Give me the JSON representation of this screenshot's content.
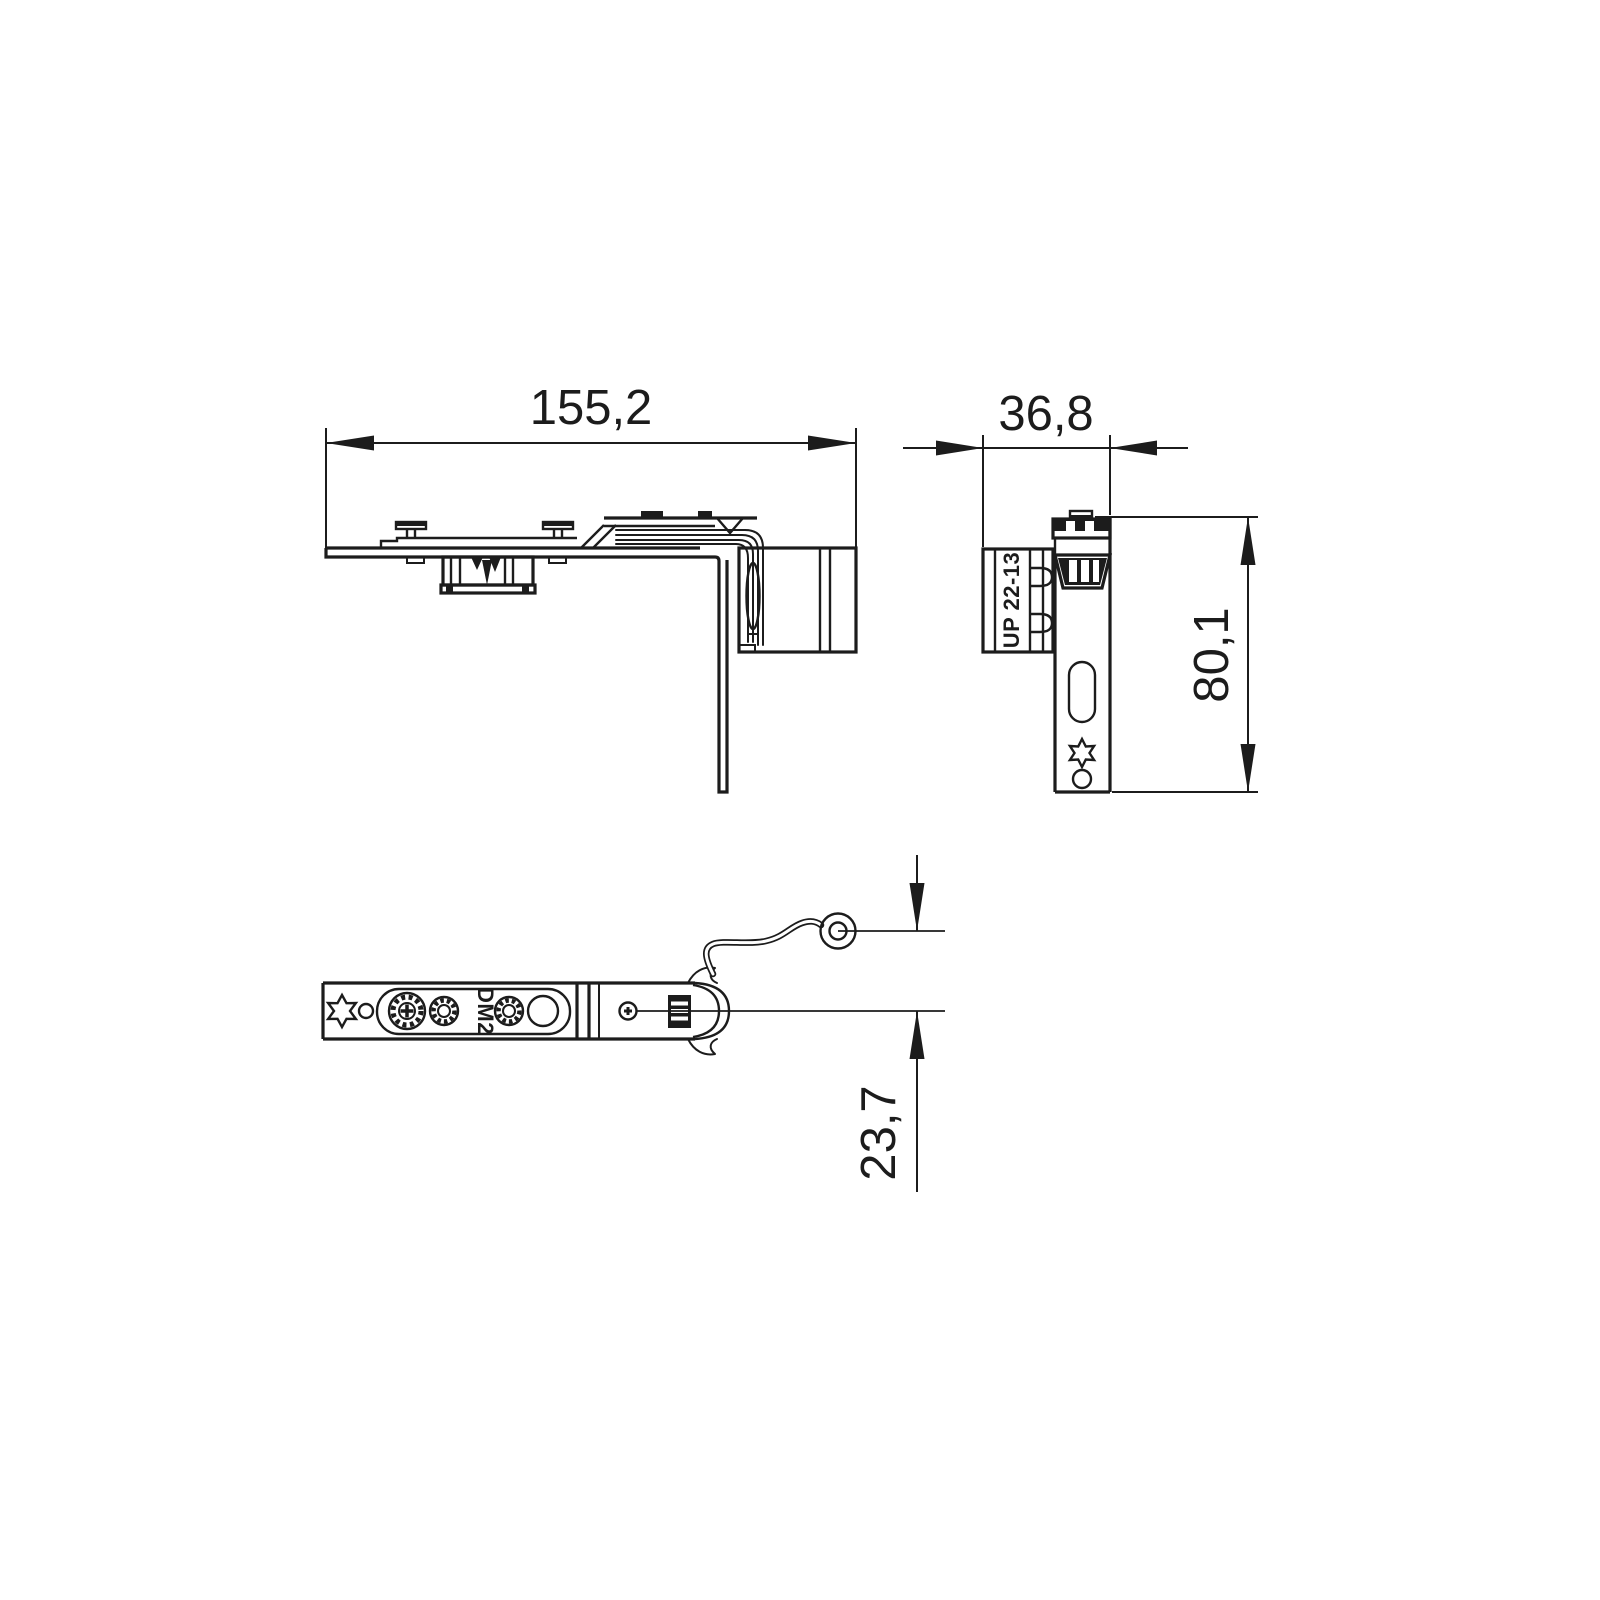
{
  "canvas": {
    "background": "#ffffff",
    "line_color": "#1c1c1c",
    "kind": "technical-drawing",
    "width_px": 1600,
    "height_px": 1600
  },
  "dimensions": {
    "overall_length": {
      "label": "155,2",
      "value": 155.2
    },
    "depth": {
      "label": "36,8",
      "value": 36.8
    },
    "height": {
      "label": "80,1",
      "value": 80.1
    },
    "pin_offset": {
      "label": "23,7",
      "value": 23.7
    }
  },
  "views": {
    "side": {
      "id": "side-view",
      "features": [
        "mounting-studs",
        "gearbox-block",
        "corner-bend-bands",
        "roller-block",
        "long-leg"
      ]
    },
    "profile": {
      "id": "profile-view",
      "marking": "UP 22-13",
      "features": [
        "castellated-cap",
        "toothed-gear",
        "oblong-slot",
        "torx-star",
        "round-hole",
        "notch-pins"
      ]
    },
    "bottom": {
      "id": "bottom-view",
      "marking": "DM2",
      "features": [
        "torx-star",
        "pin-hole",
        "phillips-adjust-screw",
        "knurled-screw",
        "knurled-screw",
        "round-hole",
        "phillips-screw-small",
        "spring-clip",
        "pivot-wire",
        "pivot-loop"
      ]
    }
  }
}
